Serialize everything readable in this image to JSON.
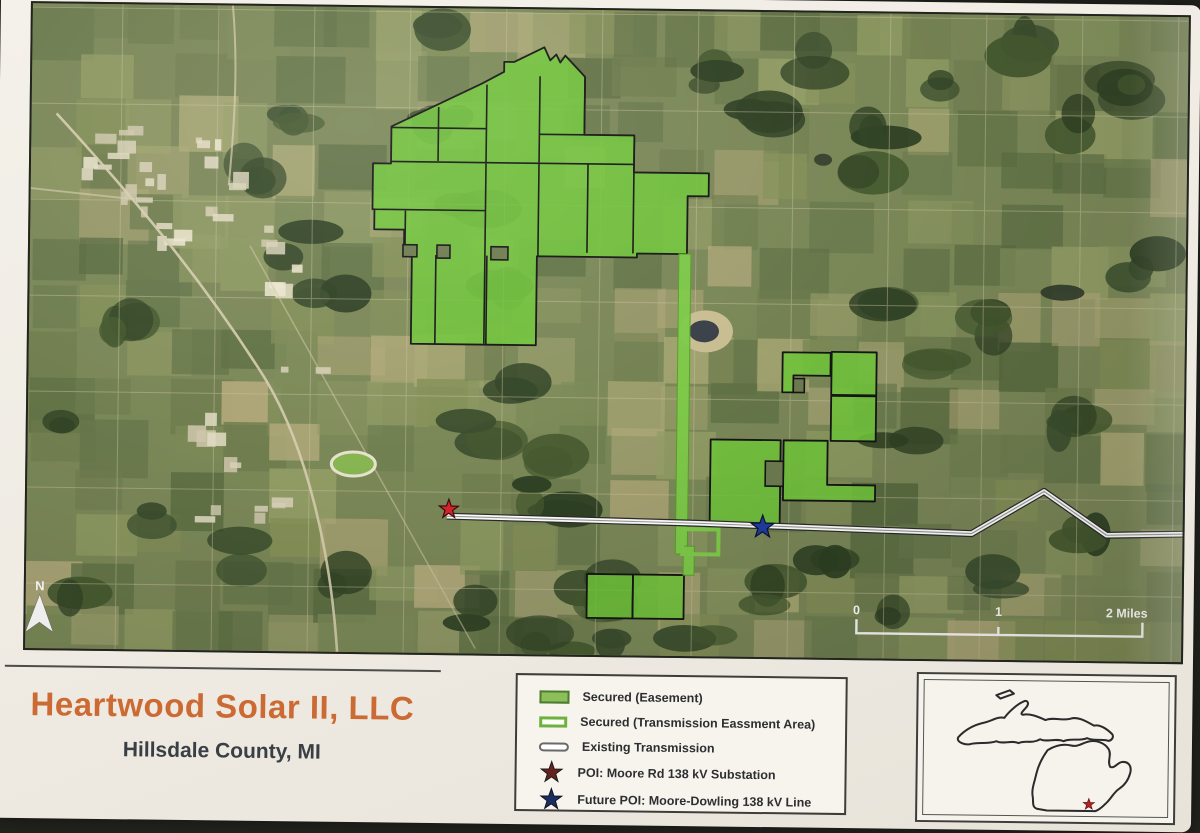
{
  "photo": {
    "background_color": "#24241f",
    "paper_color": "#f1ede5"
  },
  "title": {
    "text": "Heartwood Solar II, LLC",
    "subtitle": "Hillsdale County, MI",
    "title_color": "#cc6a34",
    "subtitle_color": "#3a3f45"
  },
  "legend": {
    "items": [
      {
        "label": "Secured (Easement)",
        "swatch": "green-fill",
        "fill": "#8cbf57",
        "border": "#4e7a33"
      },
      {
        "label": "Secured (Transmission Eassment Area)",
        "swatch": "green-outline",
        "fill": "#fdfdf8",
        "border": "#6db13f"
      },
      {
        "label": "Existing Transmission",
        "swatch": "white-pill",
        "fill": "#ffffff",
        "border": "#6a6a6a"
      },
      {
        "label": "POI: Moore Rd 138 kV Substation",
        "swatch": "star",
        "fill": "#66201d",
        "border": "#1c1c1c"
      },
      {
        "label": "Future POI: Moore-Dowling 138 kV Line",
        "swatch": "star",
        "fill": "#1c2d62",
        "border": "#10131c"
      }
    ]
  },
  "map": {
    "colors": {
      "parcel_fill": "#71c43c",
      "parcel_stroke": "#151515",
      "corridor": "#7ecb49",
      "cutout_fill": "#6e7b4f",
      "line_core": "#ffffff",
      "line_edge": "#2a2a2a"
    },
    "parcels": [
      {
        "name": "secured-parcel-main-cluster",
        "pts": "390,129 480,85 502,73 502,63 512,63 542,48 548,61 554,55 558,63 563,56 583,77 583,135 633,135 633,172 708,172 708,195 687,195 687,253 637,253 637,257 537,257 537,346 412,346 412,257 404,257 404,232 374,232 374,212 372,212 372,166 390,166"
      },
      {
        "name": "secured-parcel-ne-1",
        "pts": "784,350 832,350 832,373 795,373 795,390 784,390"
      },
      {
        "name": "secured-parcel-ne-2",
        "pts": "833,349 878,349 878,392 833,392"
      },
      {
        "name": "secured-parcel-ne-3",
        "pts": "833,393 878,393 878,438 833,438"
      },
      {
        "name": "secured-parcel-mid-1",
        "pts": "713,438 783,438 783,523 713,523"
      },
      {
        "name": "secured-parcel-mid-2",
        "pts": "786,438 830,438 830,482 878,482 878,498 786,498"
      },
      {
        "name": "secured-parcel-south-1",
        "pts": "591,574 637,574 637,618 591,618"
      },
      {
        "name": "secured-parcel-south-2",
        "pts": "637,574 688,574 688,618 637,618"
      }
    ],
    "parcel_lines": [
      [
        437,
        109,
        437,
        163
      ],
      [
        485,
        86,
        485,
        345
      ],
      [
        538,
        77,
        538,
        257
      ],
      [
        583,
        77,
        583,
        135
      ],
      [
        538,
        135,
        583,
        135
      ],
      [
        390,
        130,
        485,
        130
      ],
      [
        390,
        164,
        633,
        164
      ],
      [
        372,
        212,
        485,
        212
      ],
      [
        405,
        213,
        405,
        257
      ],
      [
        633,
        137,
        633,
        253
      ],
      [
        587,
        164,
        587,
        253
      ],
      [
        436,
        257,
        436,
        346
      ],
      [
        487,
        257,
        487,
        346
      ],
      [
        637,
        574,
        637,
        618
      ]
    ],
    "cutouts": [
      [
        403,
        247,
        14,
        12
      ],
      [
        437,
        247,
        13,
        13
      ],
      [
        491,
        248,
        17,
        13
      ],
      [
        795,
        376,
        11,
        14
      ],
      [
        768,
        459,
        18,
        25
      ]
    ],
    "corridor": {
      "strips": [
        [
          679,
          253,
          12,
          300
        ],
        [
          687,
          545,
          11,
          29
        ]
      ],
      "frame": [
        686,
        528,
        36,
        25
      ]
    },
    "transmission_line": [
      [
        450,
        518
      ],
      [
        700,
        522
      ],
      [
        975,
        529
      ],
      [
        1047,
        486
      ],
      [
        1110,
        529
      ],
      [
        1186,
        527
      ]
    ],
    "stars": [
      {
        "name": "substation-star",
        "x": 452,
        "y": 511,
        "r": 10,
        "color": "#d6252b",
        "edge": "#3a0c0c"
      },
      {
        "name": "future-poi-star",
        "x": 766,
        "y": 525,
        "r": 12,
        "color": "#1f3da0",
        "edge": "#0c1333"
      }
    ],
    "north_label": "N",
    "scale_bar": {
      "labels": [
        "0",
        "1",
        "2 Miles"
      ],
      "x0": 861,
      "x1": 1003,
      "x2": 1147,
      "ytext": 611,
      "ybar": 630
    }
  },
  "inset": {
    "star": {
      "x": 172,
      "y": 146,
      "r": 7,
      "color": "#b22222"
    }
  }
}
